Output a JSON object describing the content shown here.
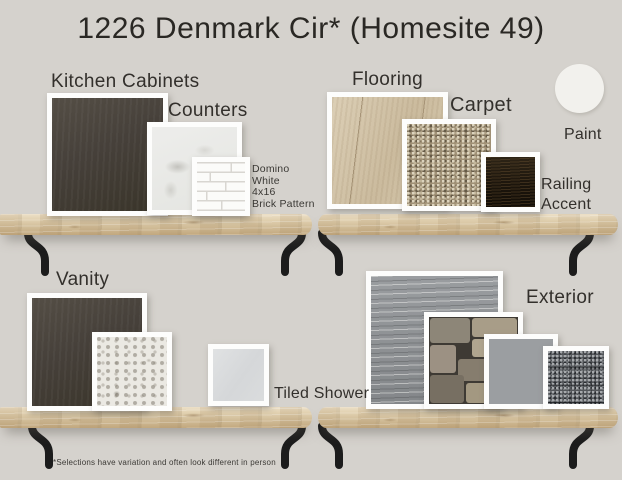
{
  "title": "1226 Denmark Cir* (Homesite 49)",
  "labels": {
    "kitchen_cabinets": "Kitchen Cabinets",
    "counters": "Counters",
    "flooring": "Flooring",
    "carpet": "Carpet",
    "railing_accent": "Railing Accent",
    "paint": "Paint",
    "vanity": "Vanity",
    "tiled_shower": "Tiled Shower",
    "exterior": "Exterior"
  },
  "counter_tile_note": {
    "lines": [
      "Domino",
      "White",
      "4x16",
      "Brick Pattern"
    ]
  },
  "disclaimer": "*Selections have variation and often look different in person",
  "colors": {
    "background": "#d5d2cd",
    "text": "#33302c",
    "kitchen_cabinet": "#46403a",
    "counter_marble": "#e9e9e6",
    "brick_tile": "#fbfbf9",
    "brick_grout": "#d8d6d1",
    "flooring": "#d2c3a9",
    "carpet": "#a09176",
    "railing_accent": "#1c150c",
    "paint": "#f2f1ed",
    "vanity_cabinet": "#46403a",
    "vanity_counter": "#ebe9e3",
    "tiled_shower": "#d8dadb",
    "exterior_siding": "#8f9294",
    "exterior_stone": "#968c7b",
    "exterior_shake": "#9b9ea1",
    "exterior_shingle": "#53565a",
    "shelf_wood": "#d8c5a4",
    "bracket": "#1c1c1c"
  }
}
